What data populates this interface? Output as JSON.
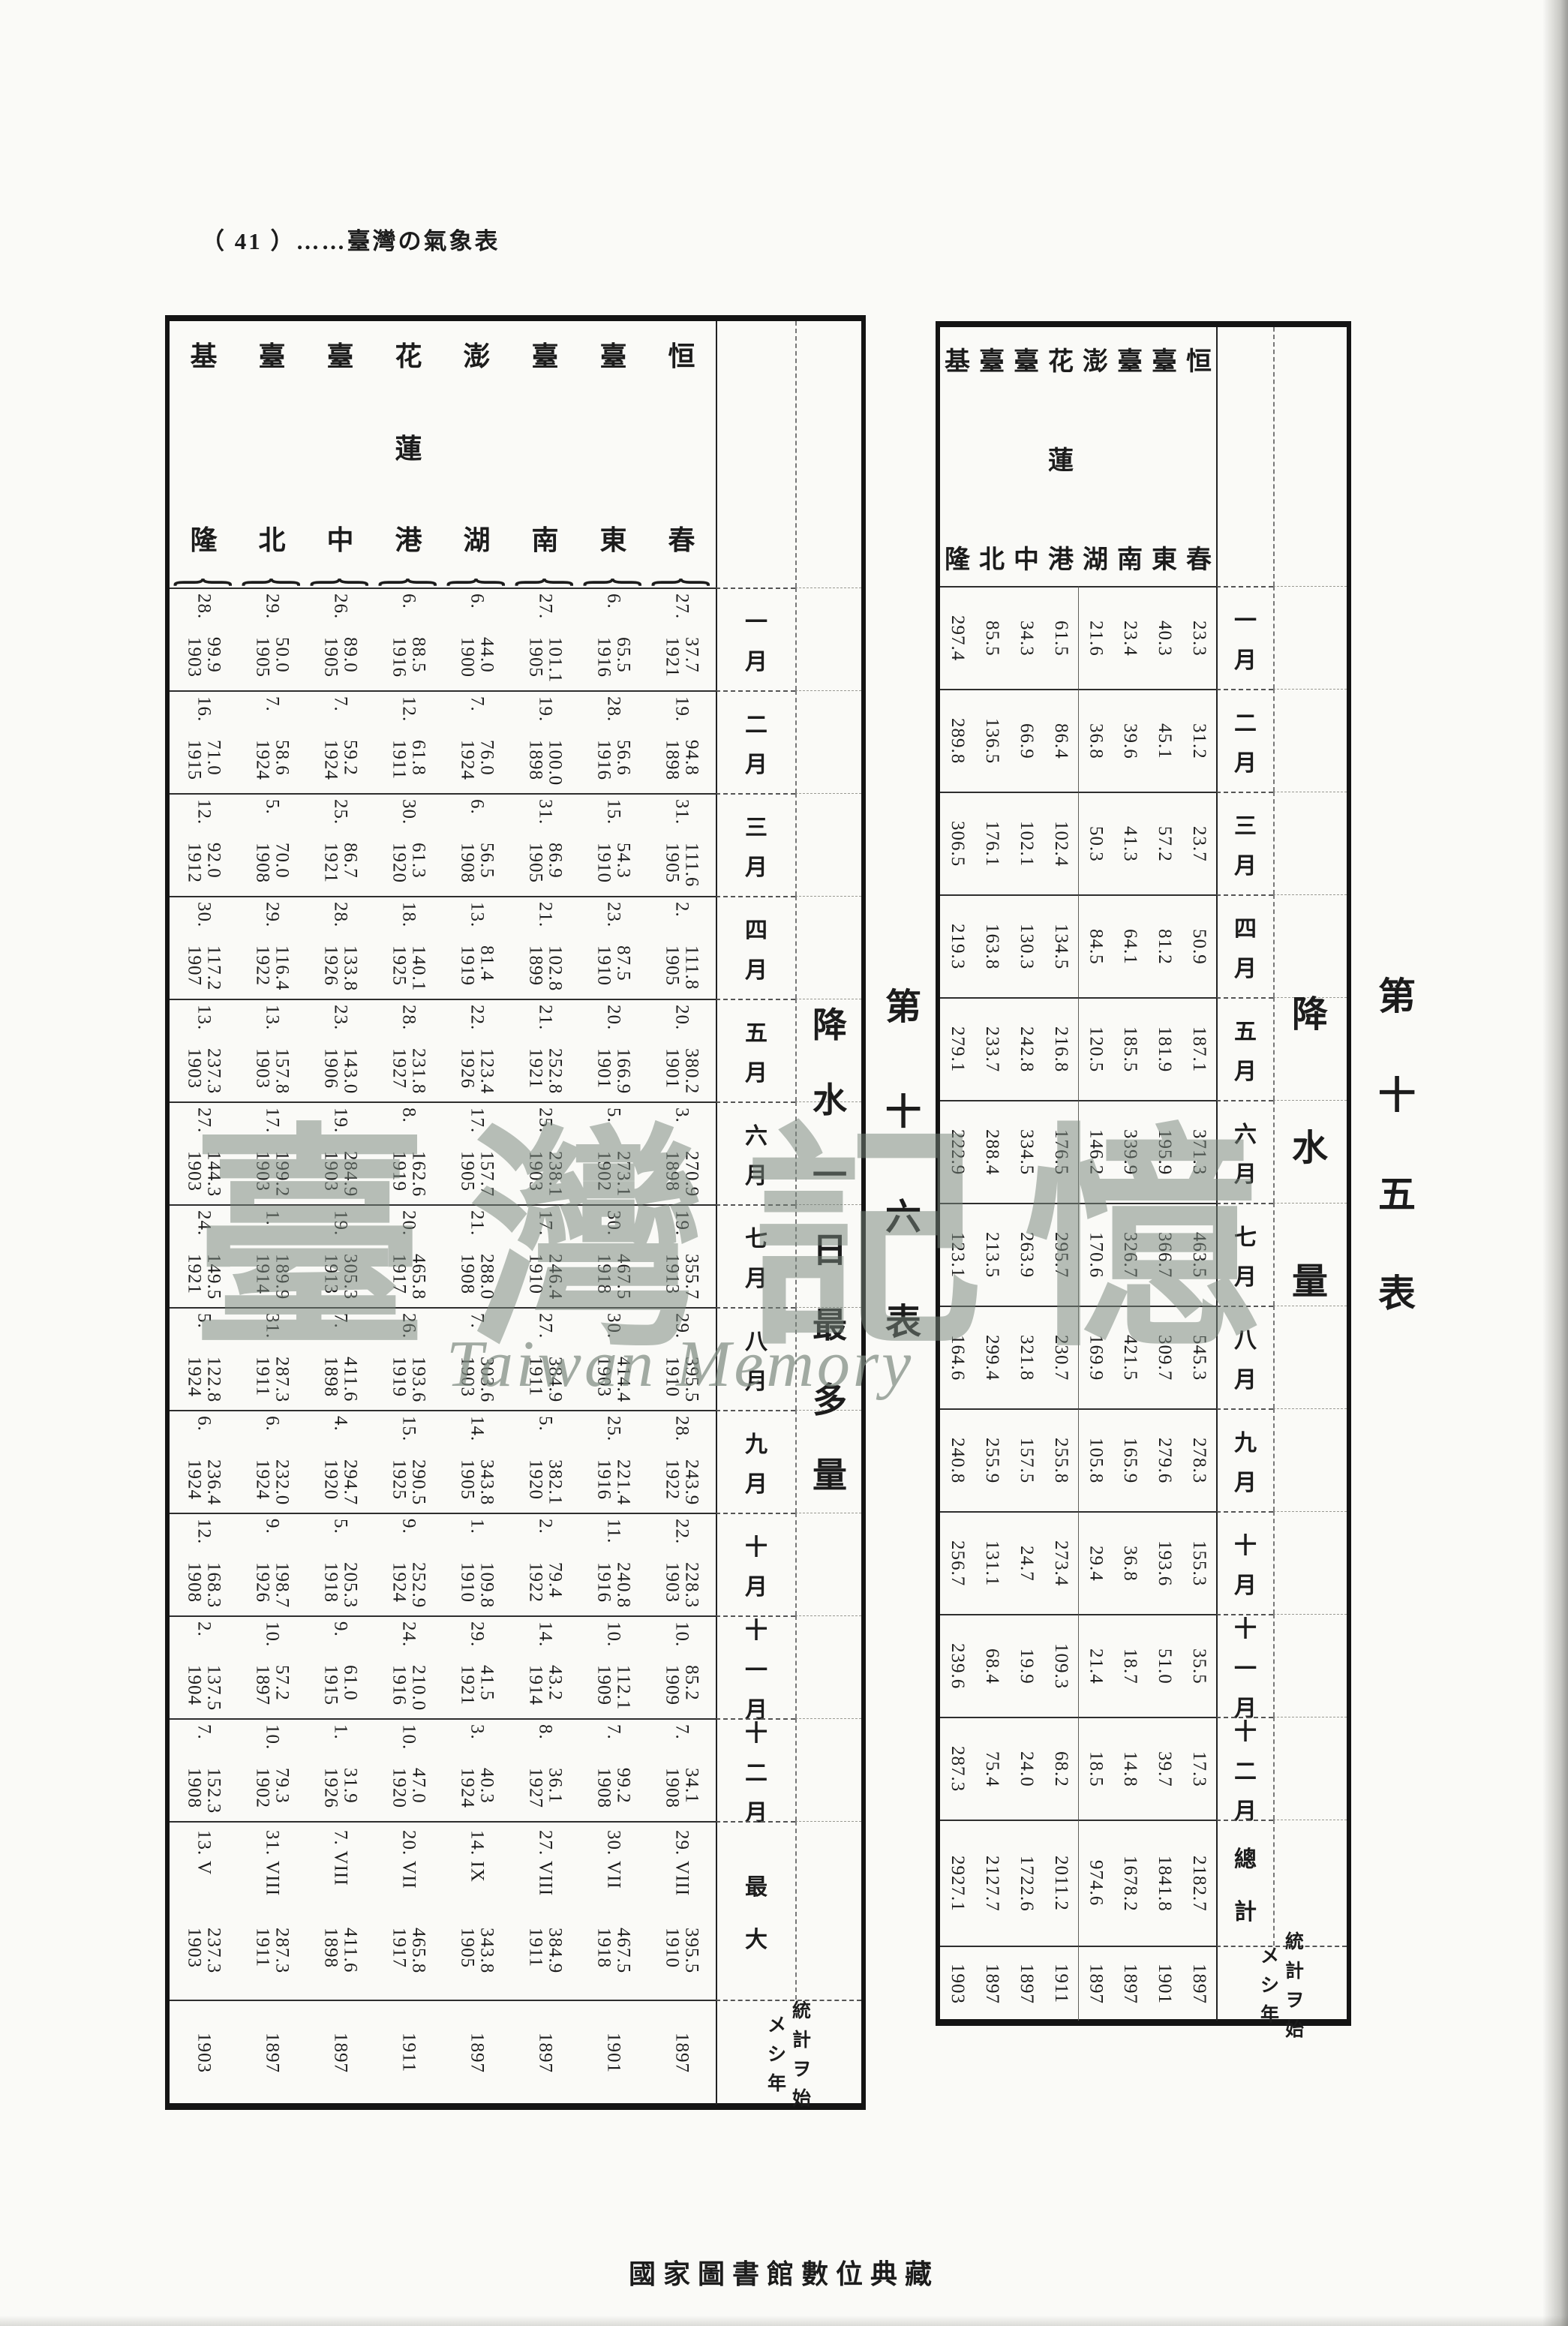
{
  "page_header": {
    "text": "（ 41 ）……臺灣の氣象表"
  },
  "footer": {
    "text": "國家圖書館數位典藏"
  },
  "watermark": {
    "cjk": "臺灣記憶",
    "latin": "Taiwan Memory"
  },
  "months": [
    "一月",
    "二月",
    "三月",
    "四月",
    "五月",
    "六月",
    "七月",
    "八月",
    "九月",
    "十月",
    "十一月",
    "十二月"
  ],
  "table15": {
    "table_no": "第十五表",
    "title": "降水量",
    "total_label": "總計",
    "start_label_line1": "統計ヲ始",
    "start_label_line2": "メシ年",
    "stations": [
      {
        "name": "基隆",
        "values": [
          "297.4",
          "289.8",
          "306.5",
          "219.3",
          "279.1",
          "222.9",
          "123.1",
          "164.6",
          "240.8",
          "256.7",
          "239.6",
          "287.3"
        ],
        "total": "2927.1",
        "start_year": "1903"
      },
      {
        "name": "臺北",
        "values": [
          "85.5",
          "136.5",
          "176.1",
          "163.8",
          "233.7",
          "288.4",
          "213.5",
          "299.4",
          "255.9",
          "131.1",
          "68.4",
          "75.4"
        ],
        "total": "2127.7",
        "start_year": "1897"
      },
      {
        "name": "臺中",
        "values": [
          "34.3",
          "66.9",
          "102.1",
          "130.3",
          "242.8",
          "334.5",
          "263.9",
          "321.8",
          "157.5",
          "24.7",
          "19.9",
          "24.0"
        ],
        "total": "1722.6",
        "start_year": "1897"
      },
      {
        "name": "花蓮港",
        "values": [
          "61.5",
          "86.4",
          "102.4",
          "134.5",
          "216.8",
          "176.5",
          "295.7",
          "230.7",
          "255.8",
          "273.4",
          "109.3",
          "68.2"
        ],
        "total": "2011.2",
        "start_year": "1911"
      },
      {
        "name": "澎湖",
        "values": [
          "21.6",
          "36.8",
          "50.3",
          "84.5",
          "120.5",
          "146.2",
          "170.6",
          "169.9",
          "105.8",
          "29.4",
          "21.4",
          "18.5"
        ],
        "total": "974.6",
        "start_year": "1897"
      },
      {
        "name": "臺南",
        "values": [
          "23.4",
          "39.6",
          "41.3",
          "64.1",
          "185.5",
          "339.9",
          "326.7",
          "421.5",
          "165.9",
          "36.8",
          "18.7",
          "14.8"
        ],
        "total": "1678.2",
        "start_year": "1897"
      },
      {
        "name": "臺東",
        "values": [
          "40.3",
          "45.1",
          "57.2",
          "81.2",
          "181.9",
          "195.9",
          "366.7",
          "309.7",
          "279.6",
          "193.6",
          "51.0",
          "39.7"
        ],
        "total": "1841.8",
        "start_year": "1901"
      },
      {
        "name": "恒春",
        "values": [
          "23.3",
          "31.2",
          "23.7",
          "50.9",
          "187.1",
          "371.3",
          "463.5",
          "545.3",
          "278.3",
          "155.3",
          "35.5",
          "17.3"
        ],
        "total": "2182.7",
        "start_year": "1897"
      }
    ]
  },
  "table16": {
    "table_no": "第十六表",
    "title": "降水一日最多量",
    "max_label": "最大",
    "start_label_line1": "統計ヲ始",
    "start_label_line2": "メシ年",
    "stations": [
      {
        "name": "基隆",
        "cells": [
          [
            "99.9",
            "28.",
            "1903"
          ],
          [
            "71.0",
            "16.",
            "1915"
          ],
          [
            "92.0",
            "12.",
            "1912"
          ],
          [
            "117.2",
            "30.",
            "1907"
          ],
          [
            "237.3",
            "13.",
            "1903"
          ],
          [
            "144.3",
            "27.",
            "1903"
          ],
          [
            "149.5",
            "24.",
            "1921"
          ],
          [
            "122.8",
            "5.",
            "1924"
          ],
          [
            "236.4",
            "6.",
            "1924"
          ],
          [
            "168.3",
            "12.",
            "1908"
          ],
          [
            "137.5",
            "2.",
            "1904"
          ],
          [
            "152.3",
            "7.",
            "1908"
          ]
        ],
        "max": {
          "day": "13. V",
          "value": "237.3",
          "year": "1903"
        },
        "start_year": "1903"
      },
      {
        "name": "臺北",
        "cells": [
          [
            "50.0",
            "29.",
            "1905"
          ],
          [
            "58.6",
            "7.",
            "1924"
          ],
          [
            "70.0",
            "5.",
            "1908"
          ],
          [
            "116.4",
            "29.",
            "1922"
          ],
          [
            "157.8",
            "13.",
            "1903"
          ],
          [
            "199.2",
            "17.",
            "1903"
          ],
          [
            "189.9",
            "1.",
            "1914"
          ],
          [
            "287.3",
            "31.",
            "1911"
          ],
          [
            "232.0",
            "6.",
            "1924"
          ],
          [
            "198.7",
            "9.",
            "1926"
          ],
          [
            "57.2",
            "10.",
            "1897"
          ],
          [
            "79.3",
            "10.",
            "1902"
          ]
        ],
        "max": {
          "day": "31. VIII",
          "value": "287.3",
          "year": "1911"
        },
        "start_year": "1897"
      },
      {
        "name": "臺中",
        "cells": [
          [
            "89.0",
            "26.",
            "1905"
          ],
          [
            "59.2",
            "7.",
            "1924"
          ],
          [
            "86.7",
            "25.",
            "1921"
          ],
          [
            "133.8",
            "28.",
            "1926"
          ],
          [
            "143.0",
            "23.",
            "1906"
          ],
          [
            "284.9",
            "19.",
            "1903"
          ],
          [
            "305.3",
            "19.",
            "1913"
          ],
          [
            "411.6",
            "7.",
            "1898"
          ],
          [
            "294.7",
            "4.",
            "1920"
          ],
          [
            "205.3",
            "5.",
            "1918"
          ],
          [
            "61.0",
            "9.",
            "1915"
          ],
          [
            "31.9",
            "1.",
            "1926"
          ]
        ],
        "max": {
          "day": "7. VIII",
          "value": "411.6",
          "year": "1898"
        },
        "start_year": "1897"
      },
      {
        "name": "花蓮港",
        "cells": [
          [
            "88.5",
            "6.",
            "1916"
          ],
          [
            "61.8",
            "12.",
            "1911"
          ],
          [
            "61.3",
            "30.",
            "1920"
          ],
          [
            "140.1",
            "18.",
            "1925"
          ],
          [
            "231.8",
            "28.",
            "1927"
          ],
          [
            "162.6",
            "8.",
            "1919"
          ],
          [
            "465.8",
            "20.",
            "1917"
          ],
          [
            "193.6",
            "26.",
            "1919"
          ],
          [
            "290.5",
            "15.",
            "1925"
          ],
          [
            "252.9",
            "9.",
            "1924"
          ],
          [
            "210.0",
            "24.",
            "1916"
          ],
          [
            "47.0",
            "10.",
            "1920"
          ]
        ],
        "max": {
          "day": "20. VII",
          "value": "465.8",
          "year": "1917"
        },
        "start_year": "1911"
      },
      {
        "name": "澎湖",
        "cells": [
          [
            "44.0",
            "6.",
            "1900"
          ],
          [
            "76.0",
            "7.",
            "1924"
          ],
          [
            "56.5",
            "6.",
            "1908"
          ],
          [
            "81.4",
            "13.",
            "1919"
          ],
          [
            "123.4",
            "22.",
            "1926"
          ],
          [
            "157.7",
            "17.",
            "1905"
          ],
          [
            "288.0",
            "21.",
            "1908"
          ],
          [
            "303.6",
            "7.",
            "1903"
          ],
          [
            "343.8",
            "14.",
            "1905"
          ],
          [
            "109.8",
            "1.",
            "1910"
          ],
          [
            "41.5",
            "29.",
            "1921"
          ],
          [
            "40.3",
            "3.",
            "1924"
          ]
        ],
        "max": {
          "day": "14. IX",
          "value": "343.8",
          "year": "1905"
        },
        "start_year": "1897"
      },
      {
        "name": "臺南",
        "cells": [
          [
            "101.1",
            "27.",
            "1905"
          ],
          [
            "100.0",
            "19.",
            "1898"
          ],
          [
            "86.9",
            "31.",
            "1905"
          ],
          [
            "102.8",
            "21.",
            "1899"
          ],
          [
            "252.8",
            "21.",
            "1921"
          ],
          [
            "238.1",
            "25.",
            "1903"
          ],
          [
            "246.4",
            "17.",
            "1910"
          ],
          [
            "384.9",
            "27.",
            "1911"
          ],
          [
            "382.1",
            "5.",
            "1920"
          ],
          [
            "79.4",
            "2.",
            "1922"
          ],
          [
            "43.2",
            "14.",
            "1914"
          ],
          [
            "36.1",
            "8.",
            "1927"
          ]
        ],
        "max": {
          "day": "27. VIII",
          "value": "384.9",
          "year": "1911"
        },
        "start_year": "1897"
      },
      {
        "name": "臺東",
        "cells": [
          [
            "65.5",
            "6.",
            "1916"
          ],
          [
            "56.6",
            "28.",
            "1916"
          ],
          [
            "54.3",
            "15.",
            "1910"
          ],
          [
            "87.5",
            "23.",
            "1910"
          ],
          [
            "166.9",
            "20.",
            "1901"
          ],
          [
            "273.1",
            "5.",
            "1902"
          ],
          [
            "467.5",
            "30.",
            "1918"
          ],
          [
            "414.4",
            "30.",
            "1903"
          ],
          [
            "221.4",
            "25.",
            "1916"
          ],
          [
            "240.8",
            "11.",
            "1916"
          ],
          [
            "112.1",
            "10.",
            "1909"
          ],
          [
            "99.2",
            "7.",
            "1908"
          ]
        ],
        "max": {
          "day": "30. VII",
          "value": "467.5",
          "year": "1918"
        },
        "start_year": "1901"
      },
      {
        "name": "恒春",
        "cells": [
          [
            "37.7",
            "27.",
            "1921"
          ],
          [
            "94.8",
            "19.",
            "1898"
          ],
          [
            "111.6",
            "31.",
            "1905"
          ],
          [
            "111.8",
            "2.",
            "1905"
          ],
          [
            "380.2",
            "20.",
            "1901"
          ],
          [
            "270.9",
            "3.",
            "1898"
          ],
          [
            "355.7",
            "19.",
            "1913"
          ],
          [
            "395.5",
            "29.",
            "1910"
          ],
          [
            "243.9",
            "28.",
            "1922"
          ],
          [
            "228.3",
            "22.",
            "1903"
          ],
          [
            "85.2",
            "10.",
            "1909"
          ],
          [
            "34.1",
            "7.",
            "1908"
          ]
        ],
        "max": {
          "day": "29. VIII",
          "value": "395.5",
          "year": "1910"
        },
        "start_year": "1897"
      }
    ]
  }
}
